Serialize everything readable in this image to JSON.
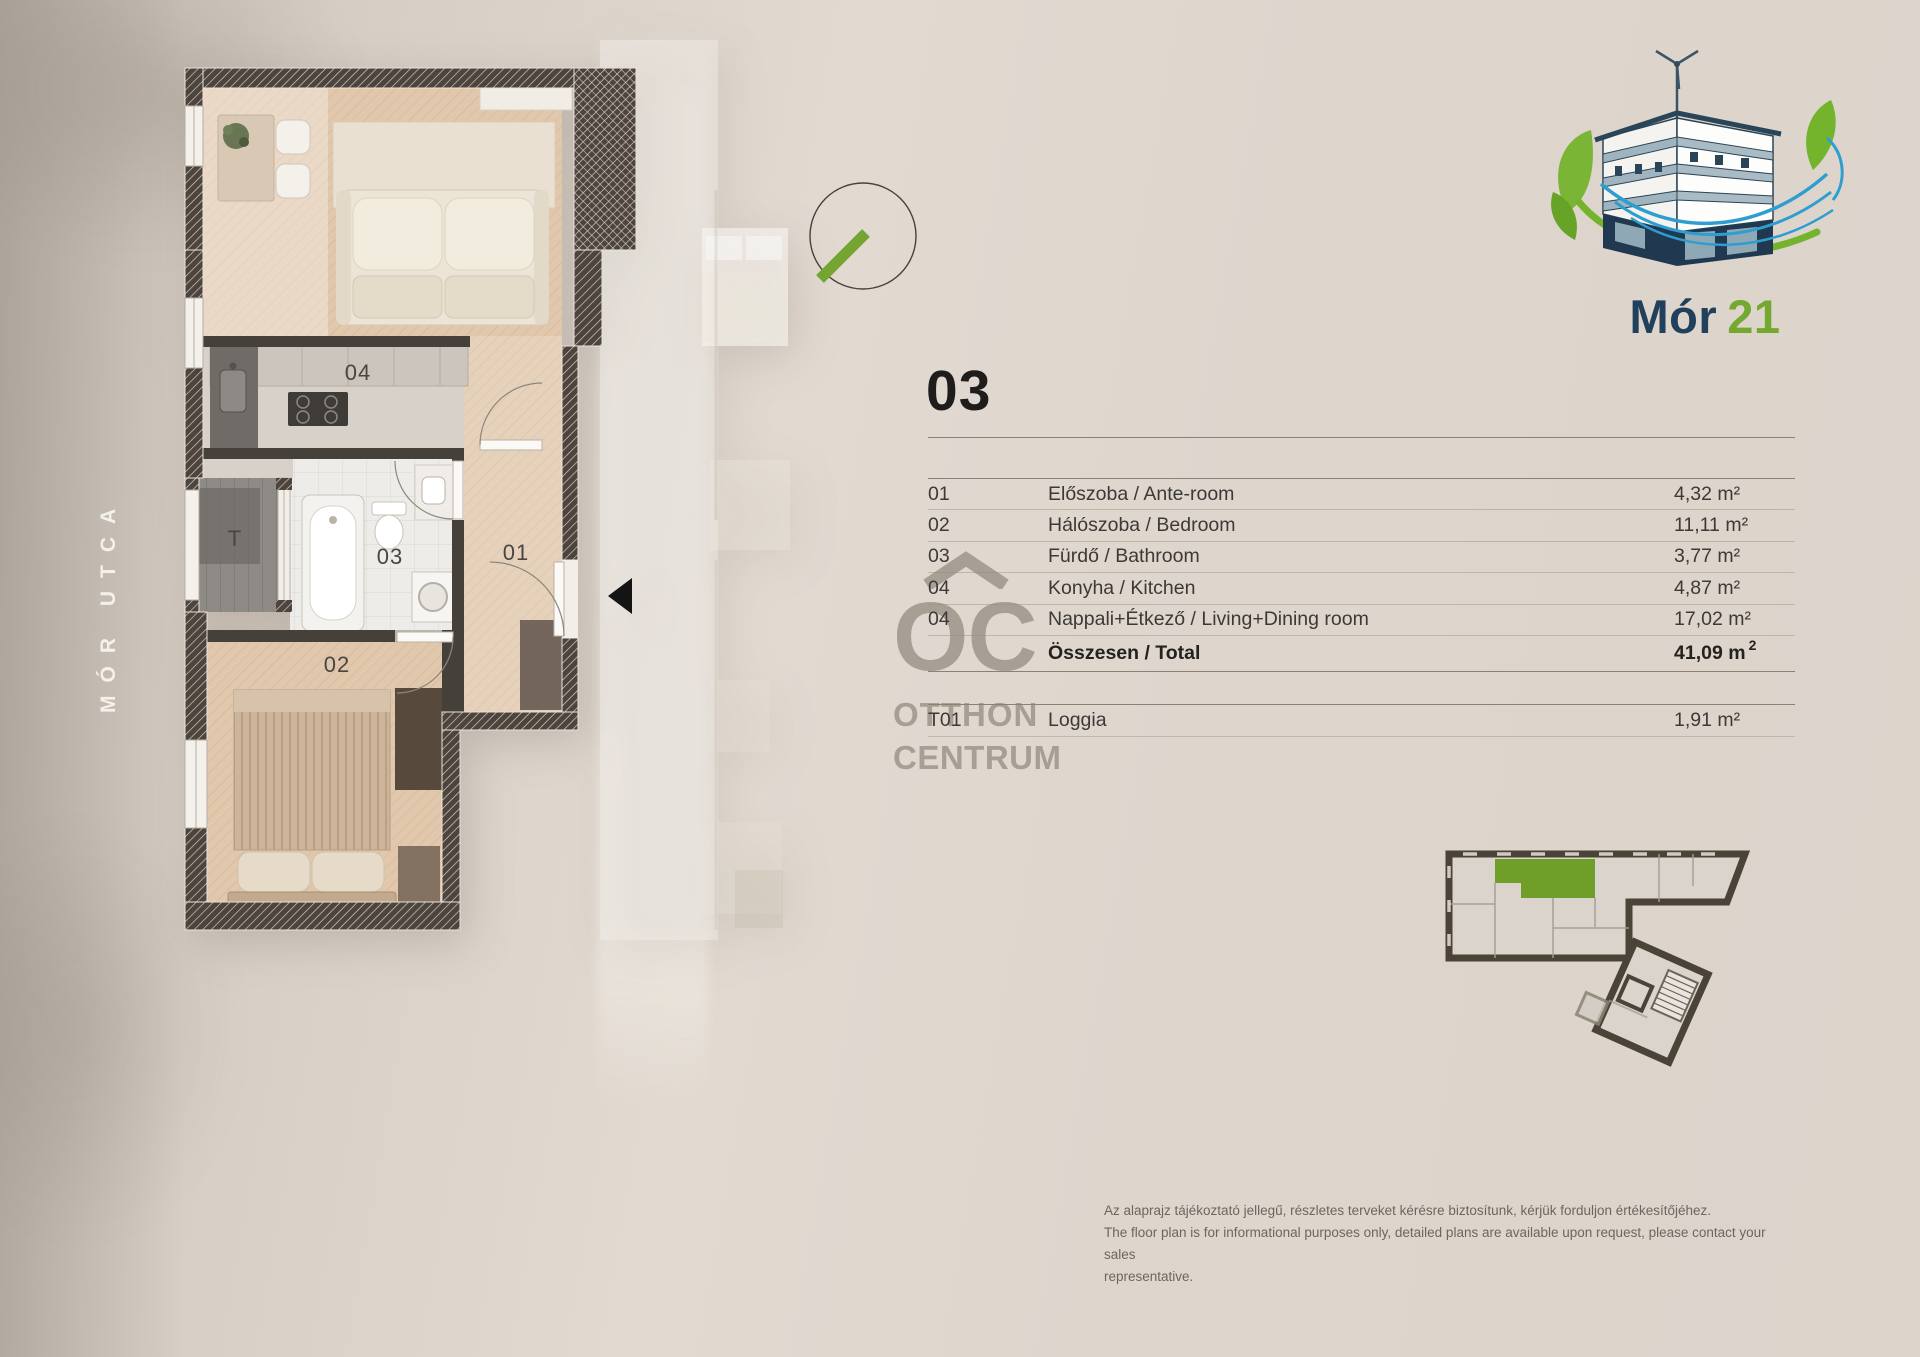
{
  "street": {
    "label": "MÓR UTCA"
  },
  "brand": {
    "name": "Mór",
    "number": "21",
    "watermark_initials": "OC",
    "watermark_line1": "OTTHON",
    "watermark_line2": "CENTRUM"
  },
  "unit": {
    "number": "03"
  },
  "table": {
    "rows": [
      {
        "num": "01",
        "name": "Előszoba / Ante-room",
        "area": "4,32 m²"
      },
      {
        "num": "02",
        "name": "Hálószoba / Bedroom",
        "area": "11,11 m²"
      },
      {
        "num": "03",
        "name": "Fürdő / Bathroom",
        "area": "3,77 m²"
      },
      {
        "num": "04",
        "name": "Konyha / Kitchen",
        "area": "4,87 m²"
      },
      {
        "num": "04",
        "name": "Nappali+Étkező / Living+Dining room",
        "area": "17,02 m²"
      }
    ],
    "total": {
      "label": "Összesen / Total",
      "value": "41,09 m",
      "sup": "2"
    },
    "extra": {
      "num": "T01",
      "name": "Loggia",
      "area": "1,91 m²"
    }
  },
  "plan": {
    "labels": {
      "kitchen": "04",
      "bathroom": "03",
      "hall": "01",
      "bedroom": "02",
      "loggia": "T"
    }
  },
  "footer": {
    "lines": [
      "Az alaprajz tájékoztató jellegű, részletes terveket kérésre biztosítunk, kérjük forduljon értékesítőjéhez.",
      "The floor plan is for informational purposes only, detailed plans are available upon request, please contact your sales",
      "representative."
    ]
  },
  "colors": {
    "green": "#74a82f",
    "navy": "#1f3f5a",
    "unit_highlight": "#6f9f28"
  }
}
